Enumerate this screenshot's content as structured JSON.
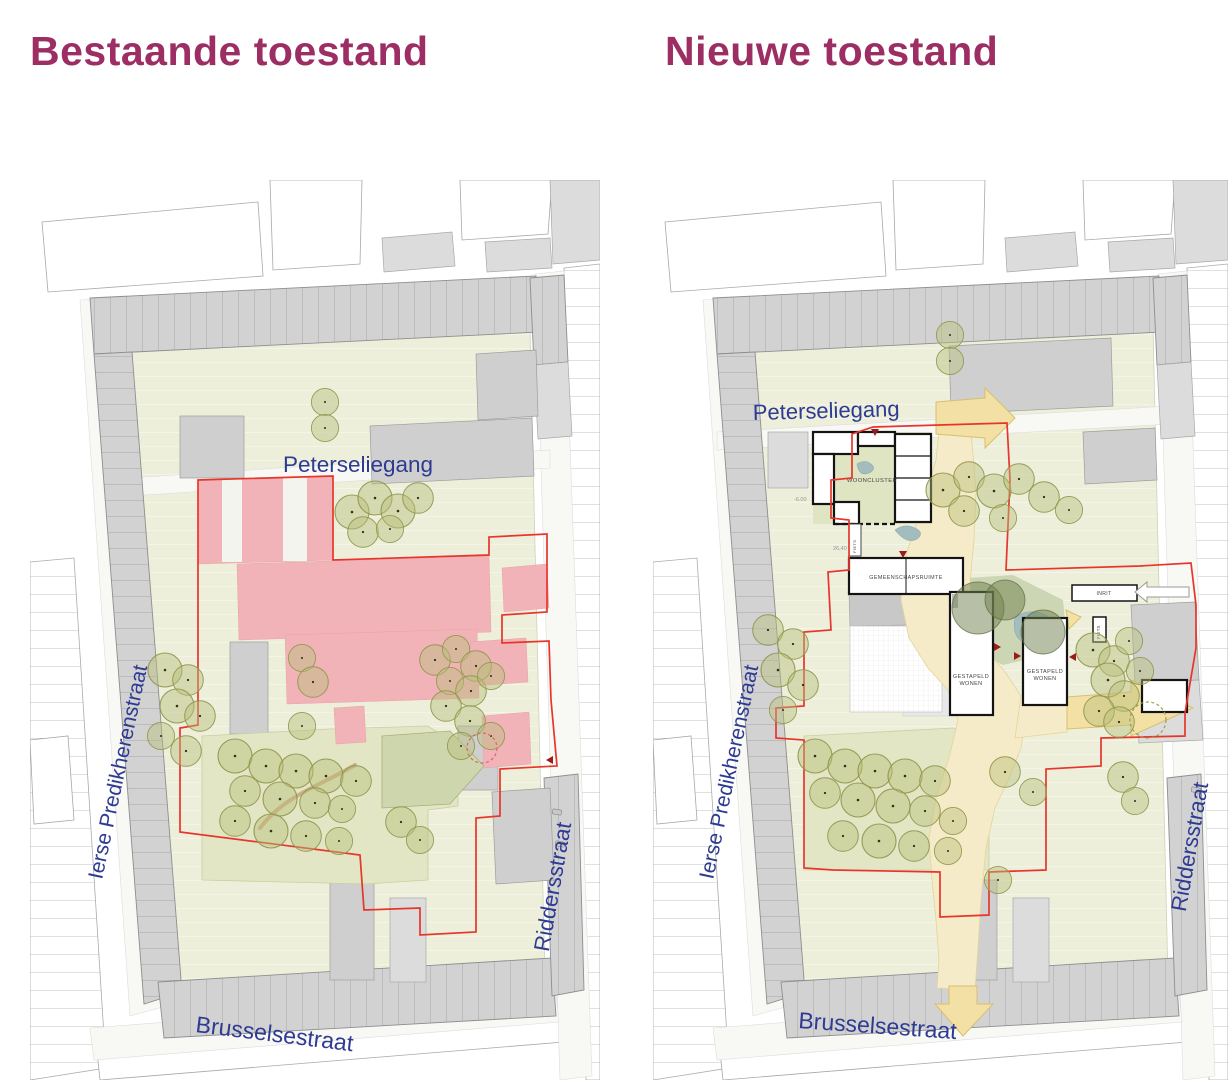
{
  "titles": {
    "left": "Bestaande toestand",
    "right": "Nieuwe toestand"
  },
  "left_map": {
    "streets": {
      "top": "Peterseliegang",
      "left": "Ierse Predikherenstraat",
      "right": "Riddersstraat",
      "bottom": "Brusselsestraat"
    }
  },
  "right_map": {
    "streets": {
      "top": "Peterseliegang",
      "left": "Ierse Predikherenstraat",
      "right": "Riddersstraat",
      "bottom": "Brusselsestraat"
    },
    "labels": {
      "wooncluster": "WOONCLUSTER",
      "gemeenschapsruimte": "GEMEENSCHAPSRUIMTE",
      "gestapeld_line1": "GESTAPELD",
      "gestapeld_line2": "WONEN",
      "inrit": "INRIT",
      "fiets": "FIETS",
      "fiets_storage": "FIETS"
    },
    "dimensions": {
      "level": "-6.00",
      "measure": "26,40"
    }
  },
  "colors": {
    "title": "#9c2e63",
    "street_label": "#2e3b92",
    "site_boundary": "#e8352b",
    "demolition_pink": "#f2b3b8",
    "tree_olive": "#8f954a",
    "route_yellow": "#f6ebc8",
    "new_building_outline": "#141414",
    "entrance_marker": "#9c1b1b",
    "pond_blue": "#a3bdbf"
  }
}
